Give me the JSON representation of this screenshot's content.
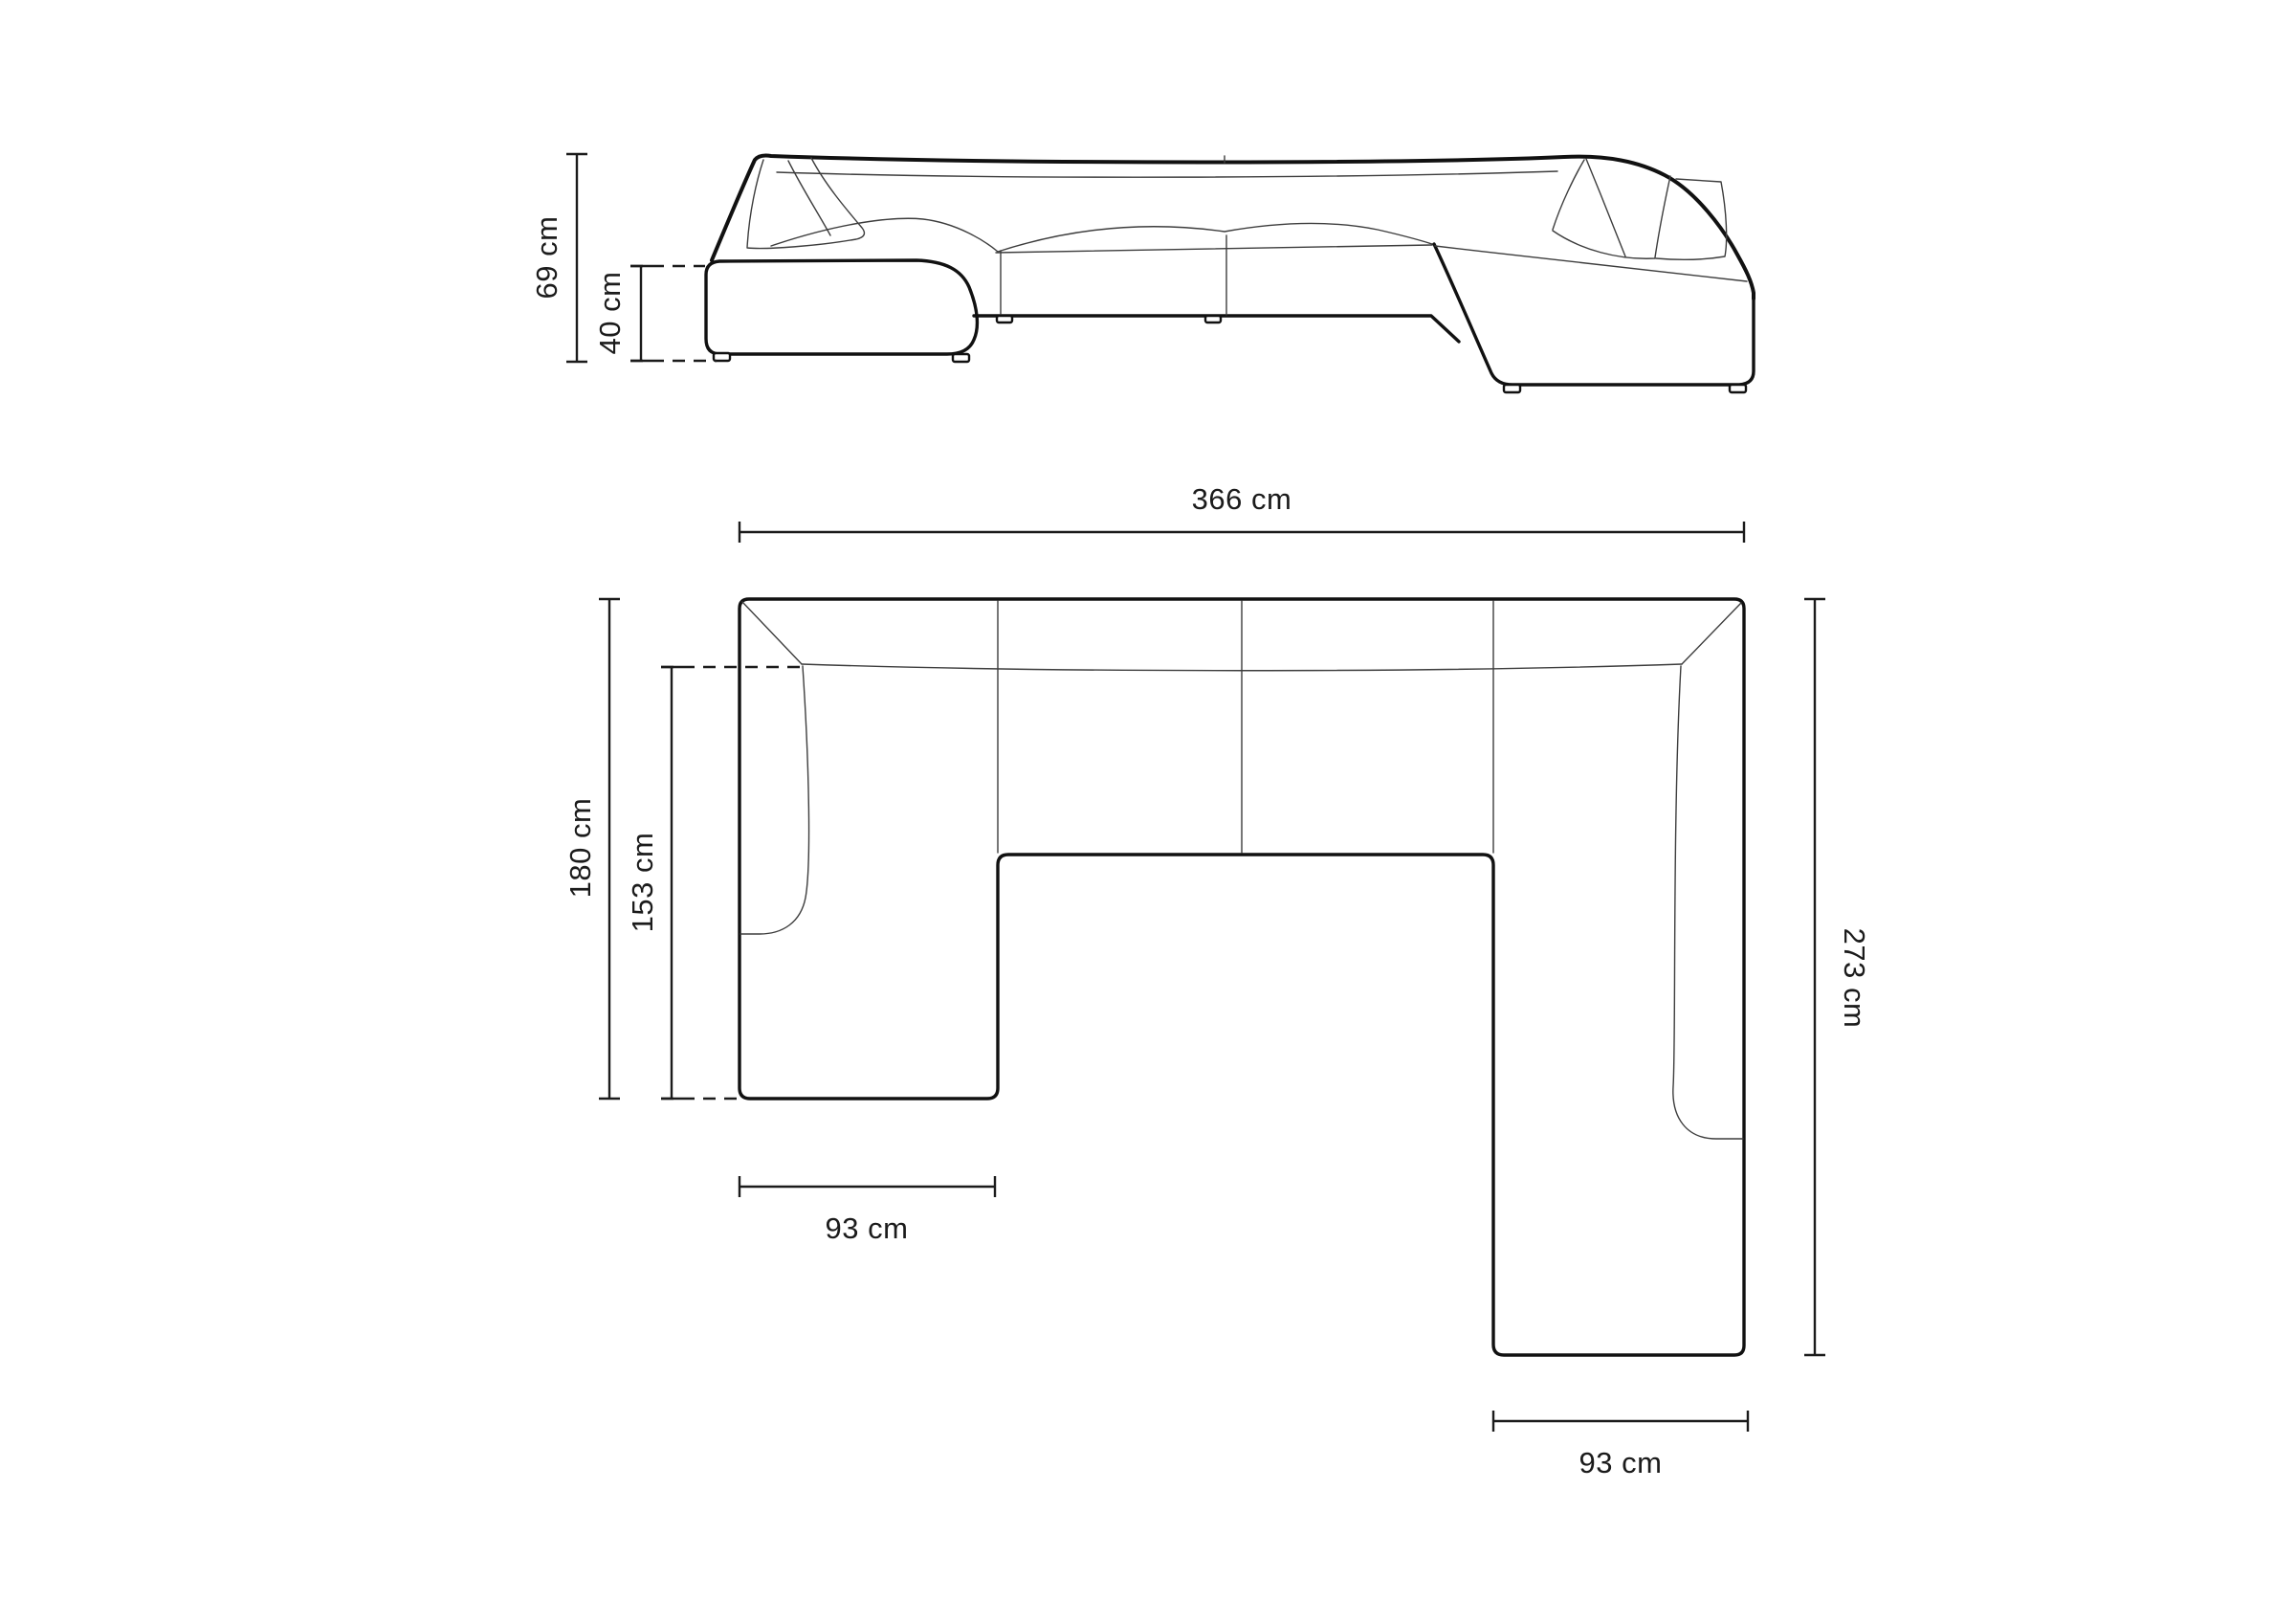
{
  "diagram": {
    "background_color": "#ffffff",
    "line_color": "#111111",
    "thin_line_color": "#3d3d3d",
    "text_color": "#1b1b1b",
    "unit": "cm",
    "views": [
      {
        "id": "front-elevation",
        "description": "front view of U-shaped modular sofa"
      },
      {
        "id": "floor-plan",
        "description": "top view of U-shaped modular sofa"
      }
    ],
    "dimensions": {
      "height_total": "69 cm",
      "seat_height": "40 cm",
      "width_total": "366 cm",
      "depth_left_total": "180 cm",
      "depth_left_inner": "153 cm",
      "chaise_left_width": "93 cm",
      "depth_right_total": "273 cm",
      "chaise_right_width": "93 cm"
    }
  }
}
